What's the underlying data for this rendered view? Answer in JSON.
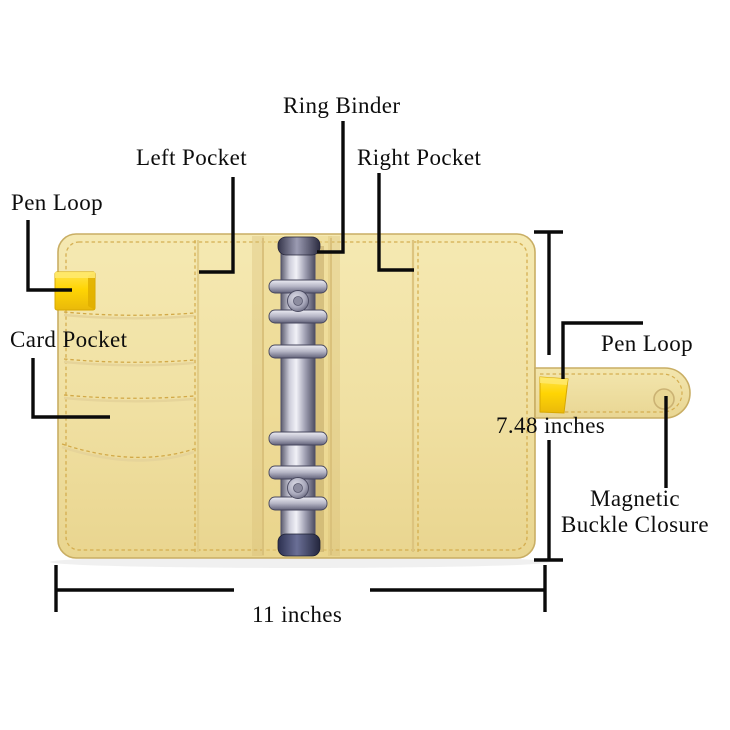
{
  "labels": {
    "pen_loop_left": "Pen Loop",
    "left_pocket": "Left Pocket",
    "ring_binder": "Ring Binder",
    "right_pocket": "Right Pocket",
    "card_pocket": "Card Pocket",
    "pen_loop_right": "Pen Loop",
    "magnetic_buckle": {
      "line1": "Magnetic",
      "line2": "Buckle Closure"
    }
  },
  "dimensions": {
    "width_label": "11 inches",
    "height_label": "7.48 inches"
  },
  "colors": {
    "leather_yellow": "#f0e0a2",
    "pen_loop_yellow": "#ffd60a",
    "metal_chrome": "#b9b9c8",
    "metal_dark": "#3d4263",
    "stitching": "#d2a948",
    "annotation_ink": "#0a0a0a",
    "background": "#ffffff"
  }
}
